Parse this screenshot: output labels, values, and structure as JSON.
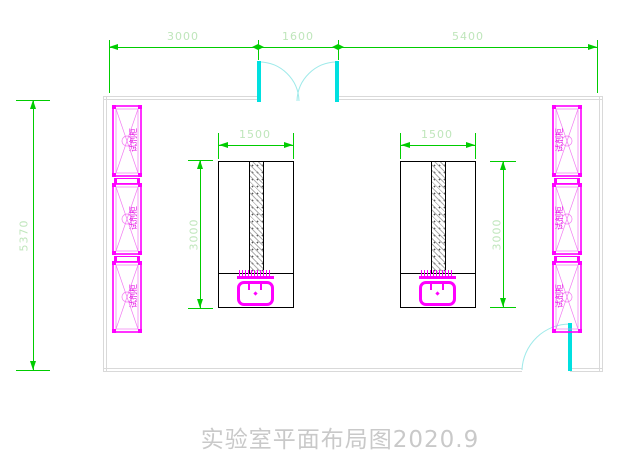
{
  "drawing": {
    "title": "实验室平面布局图2020.9",
    "dims": {
      "top_left": "3000",
      "top_mid": "1600",
      "top_right": "5400",
      "left_height": "5370",
      "bench1_width": "1500",
      "bench1_depth": "3000",
      "bench2_width": "1500",
      "bench2_depth": "3000"
    },
    "cabinets": {
      "left": [
        {
          "label": "试剂柜"
        },
        {
          "label": "试剂柜"
        },
        {
          "label": "试剂柜"
        }
      ],
      "right": [
        {
          "label": "试剂柜"
        },
        {
          "label": "试剂柜"
        },
        {
          "label": "试剂柜"
        }
      ]
    },
    "colors": {
      "dimension_line": "#00cc00",
      "dimension_text": "#bfe6bb",
      "cabinet": "#ff00ff",
      "door": "#00e0e0",
      "wall": "#d9d9d9",
      "bench_outline": "#000000",
      "title_text": "#c9c9c9"
    }
  }
}
